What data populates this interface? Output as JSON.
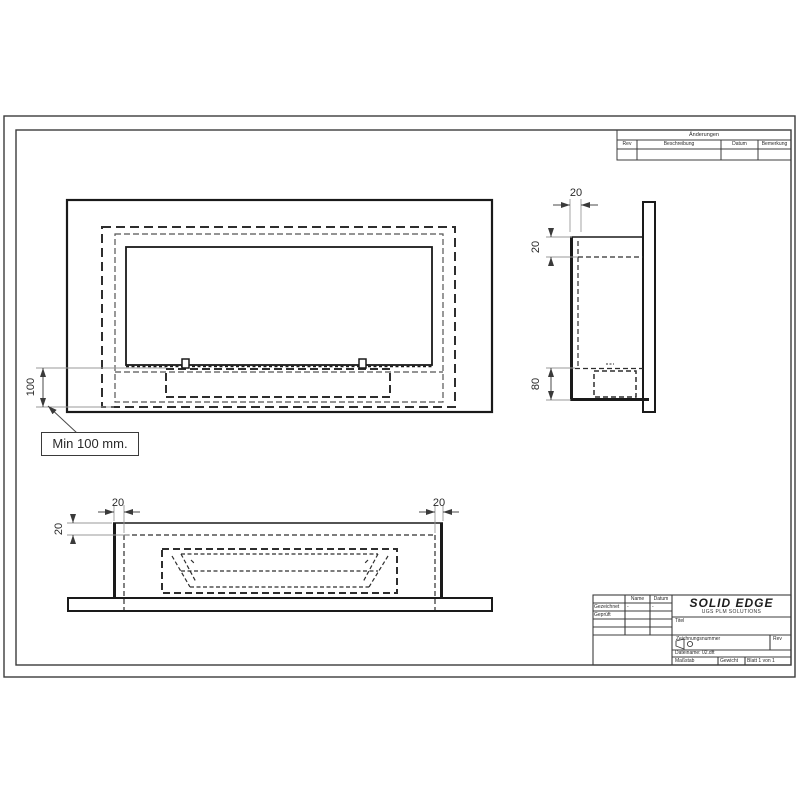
{
  "note": {
    "text": "Min 100 mm."
  },
  "dims": {
    "front_height": "100",
    "side_depth": "20",
    "side_top_offset": "20",
    "side_bottom": "80",
    "bottom_left": "20",
    "bottom_right": "20",
    "bottom_edge": "20"
  },
  "revision_table": {
    "title": "Änderungen",
    "col_rev": "Rev",
    "col_beschreibung": "Beschreibung",
    "col_datum": "Datum",
    "col_bemerkung": "Bemerkung"
  },
  "title_block": {
    "logo": "SOLID EDGE",
    "logo_sub": "UGS PLM SOLUTIONS",
    "header_name": "Name",
    "header_datum": "Datum",
    "row_gezeichnet": "Gezeichnet",
    "row_geprueft": "Geprüft",
    "gezeichnet_name": "-",
    "gezeichnet_datum": "-",
    "titel_label": "Titel",
    "number_label": "Zeichnungsnummer",
    "rev_label": "Rev",
    "file_text": "Dateiname: 02.dft",
    "scale_label": "Maßstab",
    "weight_label": "Gewicht",
    "sheet_label": "Blatt 1 von 1"
  },
  "colors": {
    "line": "#1a1a1a",
    "dashed": "#2e2e2e",
    "frame": "#3c3c3c",
    "dim": "#4a4a4a",
    "ext": "#9a9a9a"
  }
}
